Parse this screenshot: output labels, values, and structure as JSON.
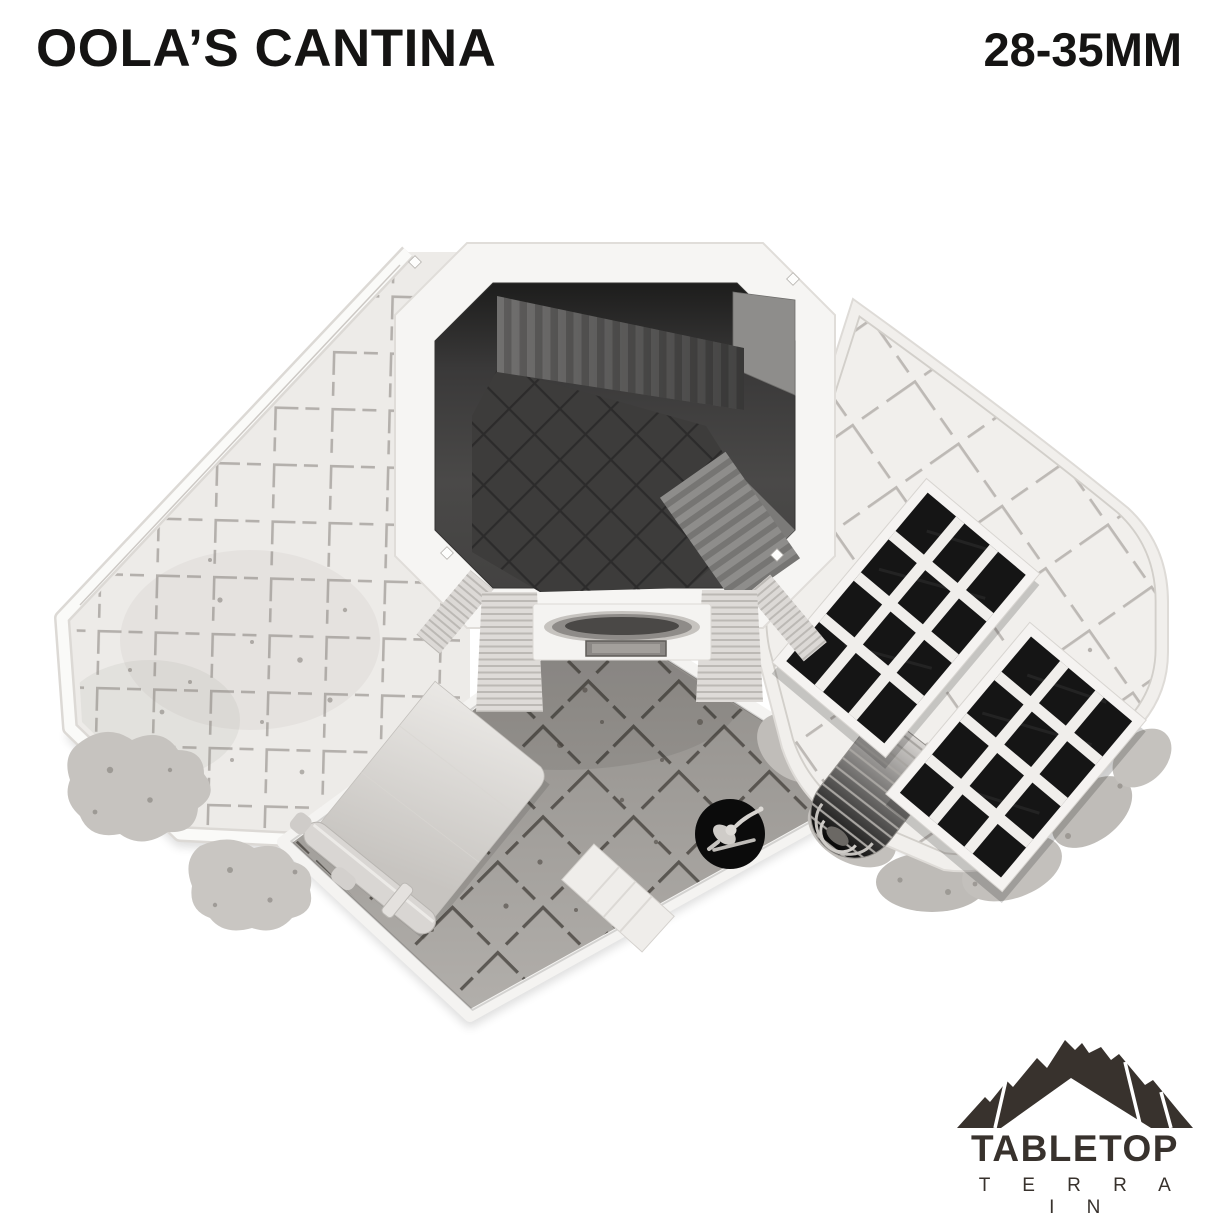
{
  "page": {
    "background": "#ffffff"
  },
  "header": {
    "title": "OOLA’S CANTINA",
    "scale_label": "28-35MM",
    "text_color": "#151413"
  },
  "render": {
    "colors": {
      "plastic_white": "#f4f2ef",
      "floor_light_tiles": "#ecebe8",
      "courtyard_tiles": "#a4a19d",
      "interior_dark": "#3c3b3a",
      "grate_black": "#151515",
      "miniature_base_black": "#0b0b0b"
    }
  },
  "logo": {
    "brand": "TABLETOP",
    "subtitle": "T E R R A I N",
    "color": "#38322d"
  }
}
